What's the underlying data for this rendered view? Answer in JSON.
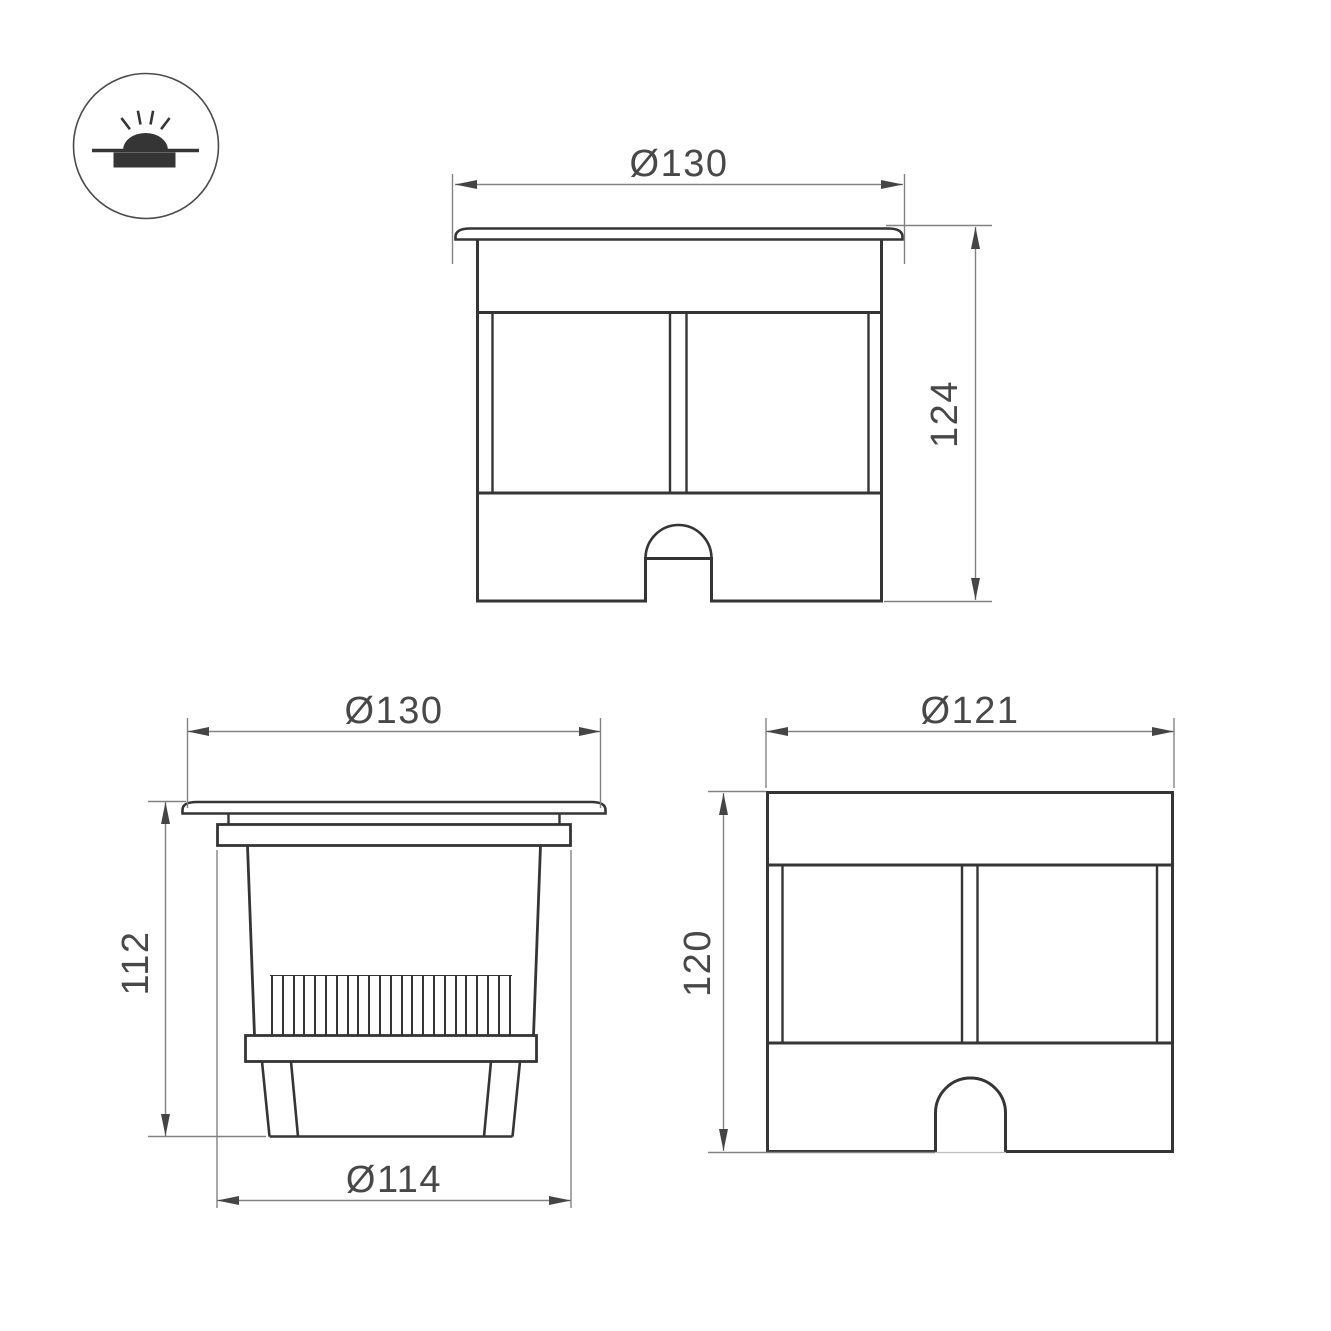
{
  "colors": {
    "object_line": "#353535",
    "dim_line": "#828282",
    "arrow": "#454545",
    "label_text": "#484848"
  },
  "icon": {
    "name": "recessed-ground-light-symbol"
  },
  "views": {
    "front": {
      "width_label": "Ø130",
      "height_label": "124"
    },
    "section": {
      "top_width_label": "Ø130",
      "height_label": "112",
      "bottom_width_label": "Ø114"
    },
    "body": {
      "width_label": "Ø121",
      "height_label": "120"
    }
  }
}
